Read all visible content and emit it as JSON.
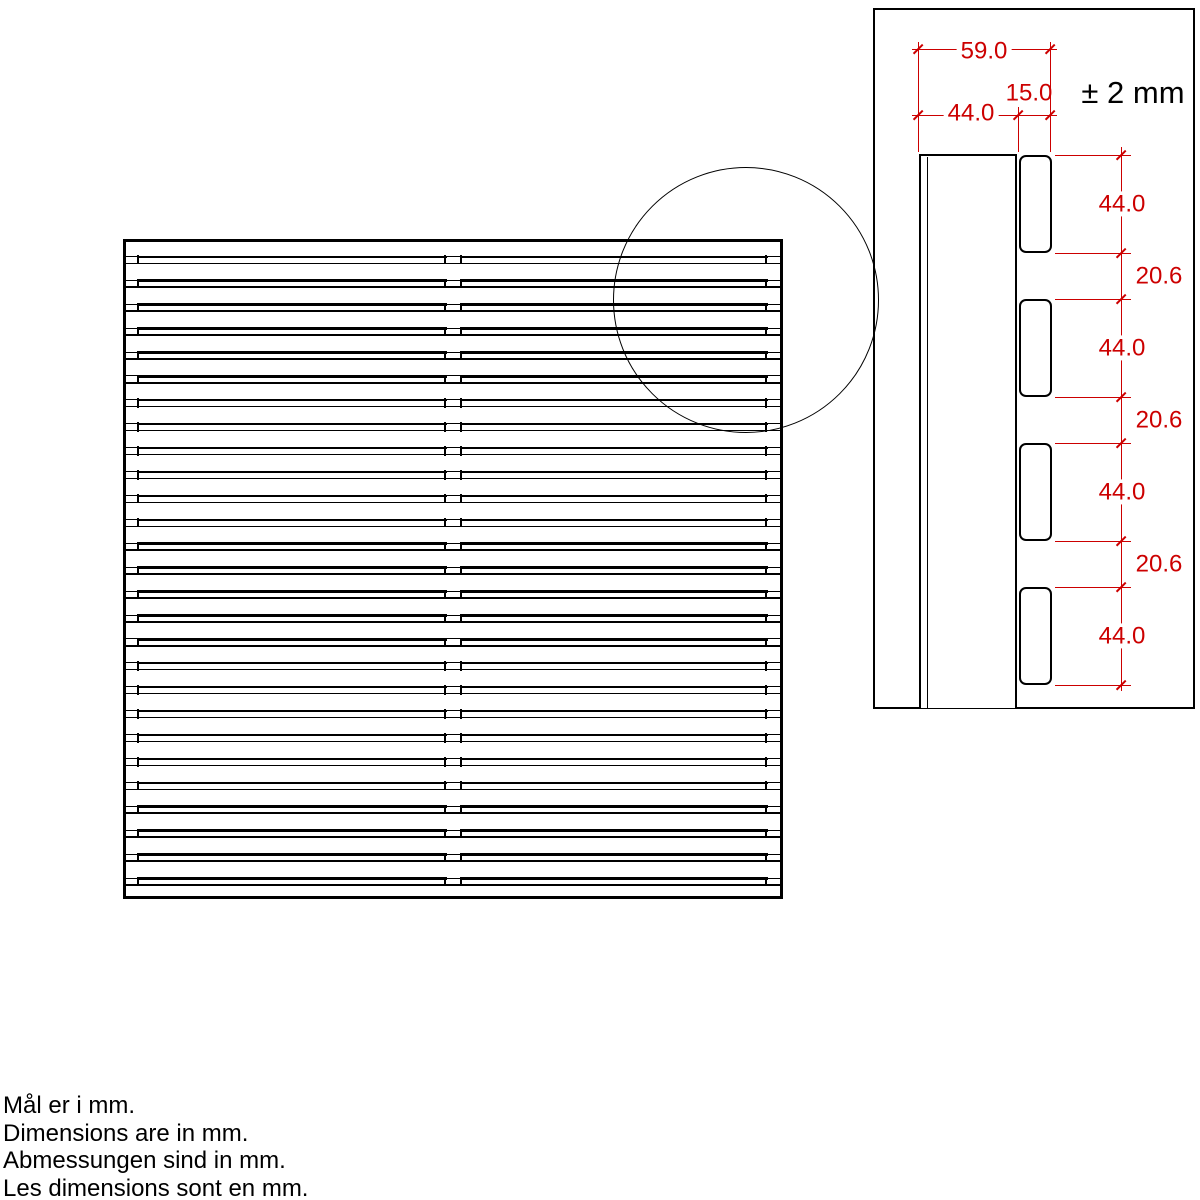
{
  "main_view": {
    "description": "slatted panel, top view",
    "separator_bands": 27
  },
  "detail_view": {
    "tolerance": "± 2 mm",
    "width_total": "59.0",
    "width_base": "44.0",
    "width_slat": "15.0",
    "side_dims": [
      "44.0",
      "20.6",
      "44.0",
      "20.6",
      "44.0",
      "20.6",
      "44.0"
    ]
  },
  "notes": {
    "da": "Mål er i mm.",
    "en": "Dimensions are in mm.",
    "de": "Abmessungen sind in mm.",
    "fr": "Les dimensions sont en mm."
  },
  "colors": {
    "dimension_red": "#cc0000",
    "line_black": "#000000",
    "background": "#ffffff"
  }
}
